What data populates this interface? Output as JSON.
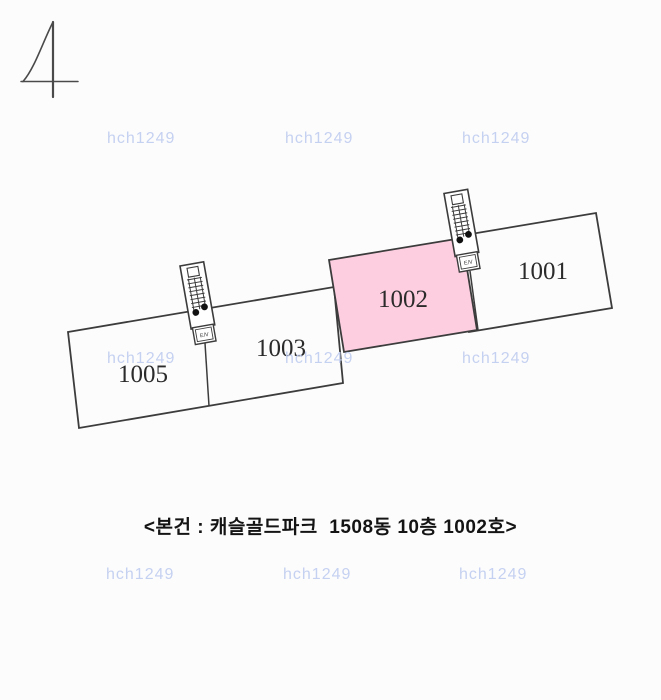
{
  "corner_mark": {
    "glyph": "4"
  },
  "watermark": {
    "text": "hch1249",
    "color": "#c3cff1"
  },
  "floor_plan": {
    "line_color": "#3c3c3c",
    "highlight_fill": "#fccee0",
    "highlight_label_color": "#c5303f",
    "elevator_label": "E/V",
    "units": [
      {
        "number": "1001",
        "highlighted": false
      },
      {
        "number": "1002",
        "highlighted": true,
        "fill": "#fccee0",
        "label_color": "#c5303f"
      },
      {
        "number": "1003",
        "highlighted": false
      },
      {
        "number": "1005",
        "highlighted": false
      }
    ]
  },
  "caption": {
    "text": "<본건 : 캐슬골드파크  1508동 10층 1002호>"
  }
}
